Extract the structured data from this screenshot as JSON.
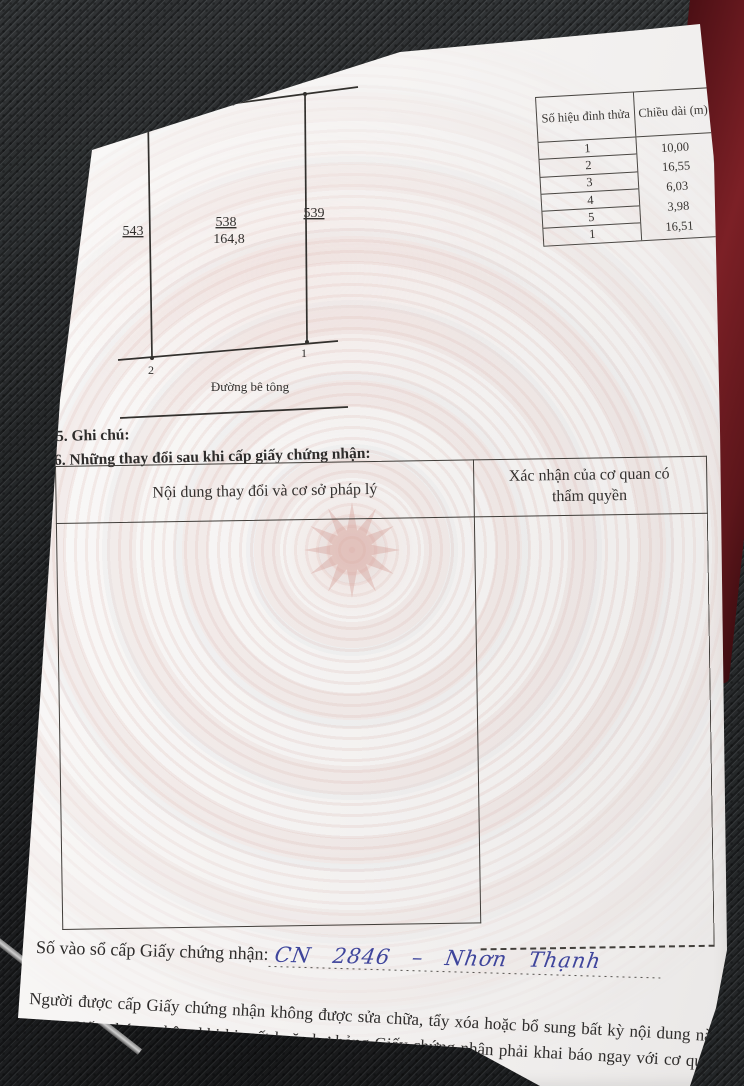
{
  "document": {
    "section4_title": "4. Sơ đồ thửa đất, tài sản gắn liền với đất:",
    "section5_title": "5. Ghi chú:",
    "section6_title": "6. Những thay đổi sau khi cấp giấy chứng nhận:",
    "footer_note": "Người được cấp Giấy chứng nhận không được sửa chữa, tẩy xóa hoặc bổ sung bất kỳ nội dung nào trong Giấy chứng nhận; khi bị mất hoặc hư hỏng Giấy chứng nhận phải khai báo ngay với cơ quan cấp Giấy.",
    "registry": {
      "label": "Số vào sổ cấp Giấy chứng nhận:",
      "handwritten": "CN 2846 – Nhơn Thạnh"
    }
  },
  "diagram": {
    "north_label": "B",
    "road_label": "Đường bê tông",
    "parcel": {
      "number": "538",
      "area": "164,8"
    },
    "adjacent": {
      "left": "543",
      "right": "539",
      "top": "48"
    },
    "vertices": {
      "top_left": "3",
      "top_mid": "4",
      "top_right": "5",
      "bottom_left": "2",
      "bottom_right": "1"
    }
  },
  "vertex_table": {
    "col1_header": "Số hiệu đỉnh thửa",
    "col2_header": "Chiều dài (m)",
    "vertex_ids": [
      "1",
      "2",
      "3",
      "4",
      "5",
      "1"
    ],
    "lengths_m": [
      "10,00",
      "16,55",
      "6,03",
      "3,98",
      "16,51"
    ]
  },
  "change_table": {
    "col1_header": "Nội dung thay đổi và cơ sở pháp lý",
    "col2_header": "Xác nhận của cơ quan có thẩm quyền"
  },
  "colors": {
    "handwriting_ink": "#3f459c",
    "book_cover": "#7c2026",
    "watermark_pink": "#d29c94"
  }
}
